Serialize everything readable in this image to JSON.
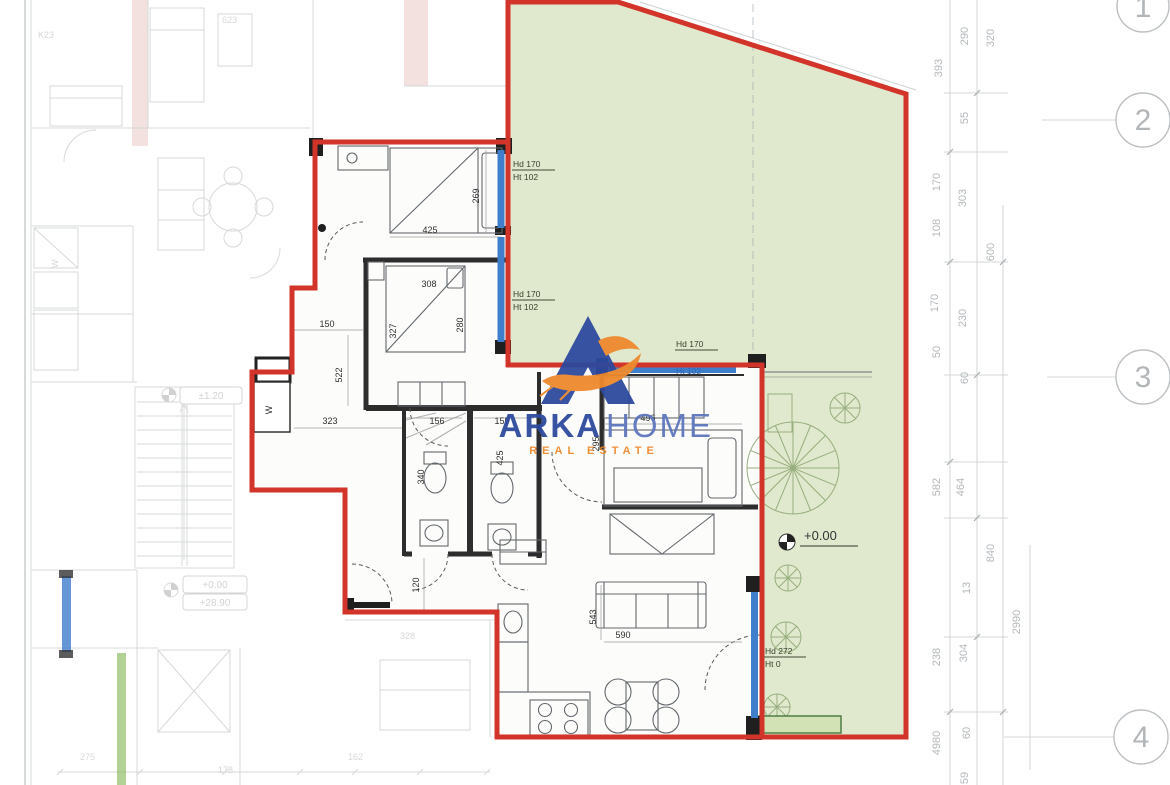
{
  "brand": {
    "word1": "ARKA",
    "word2": "HOME",
    "tagline": "REAL ESTATE"
  },
  "colors": {
    "boundary_red": "#d2342a",
    "garden_green": "#e0e9cd",
    "window_blue": "#3f7ecb",
    "logo_blue": "#2d4a9e",
    "logo_light_blue": "#5d77bd",
    "logo_orange": "#ee8a2e"
  },
  "levels": {
    "upper": "±1.20",
    "ground": "+0.00",
    "absolute": "+28.90",
    "garden": "+0.00"
  },
  "rooms": {
    "closet": "W"
  },
  "dims": {
    "bed1_w": "425",
    "bed1_h": "269",
    "bed2_w": "308",
    "bed2_h_left": "327",
    "bed2_h_right": "280",
    "hall_w": "150",
    "hall_h": "522",
    "hall_w2": "323",
    "hall_h2": "120",
    "bath_w1": "156",
    "bath_w2": "155",
    "bath_h1": "340",
    "bath_h2": "425",
    "bed3_w": "496",
    "bed3_h": "295",
    "living_h": "543",
    "living_w": "590"
  },
  "window_tags": [
    {
      "l1": "Hd 170",
      "l2": "Ht 102"
    },
    {
      "l1": "Hd 170",
      "l2": "Ht 102"
    },
    {
      "l1": "Hd 170",
      "l2": "Ht 102"
    },
    {
      "l1": "Hd 272",
      "l2": "Ht 0"
    }
  ],
  "right_dims": [
    "393",
    "290",
    "320",
    "55",
    "170",
    "108",
    "303",
    "600",
    "170",
    "230",
    "50",
    "60",
    "582",
    "464",
    "840",
    "13",
    "2990",
    "238",
    "304",
    "4980",
    "60",
    "59"
  ],
  "grid_bubbles": [
    "1",
    "2",
    "3",
    "4"
  ],
  "bg_texts": {
    "a": "K23",
    "b": "623",
    "c": "328",
    "d": "275",
    "e": "178",
    "f": "162"
  }
}
